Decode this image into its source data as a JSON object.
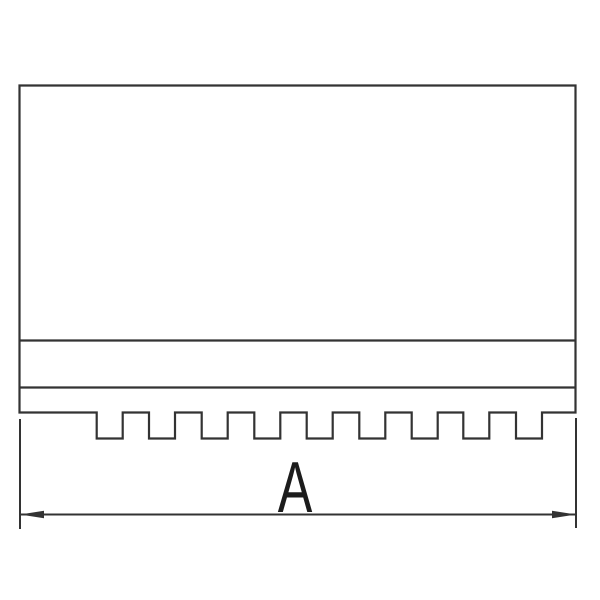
{
  "drawing": {
    "kind": "technical-line-drawing",
    "dimension": {
      "label": "A"
    },
    "colors": {
      "line": "#333333",
      "label": "#1c1c1c",
      "background": "#ffffff"
    }
  }
}
